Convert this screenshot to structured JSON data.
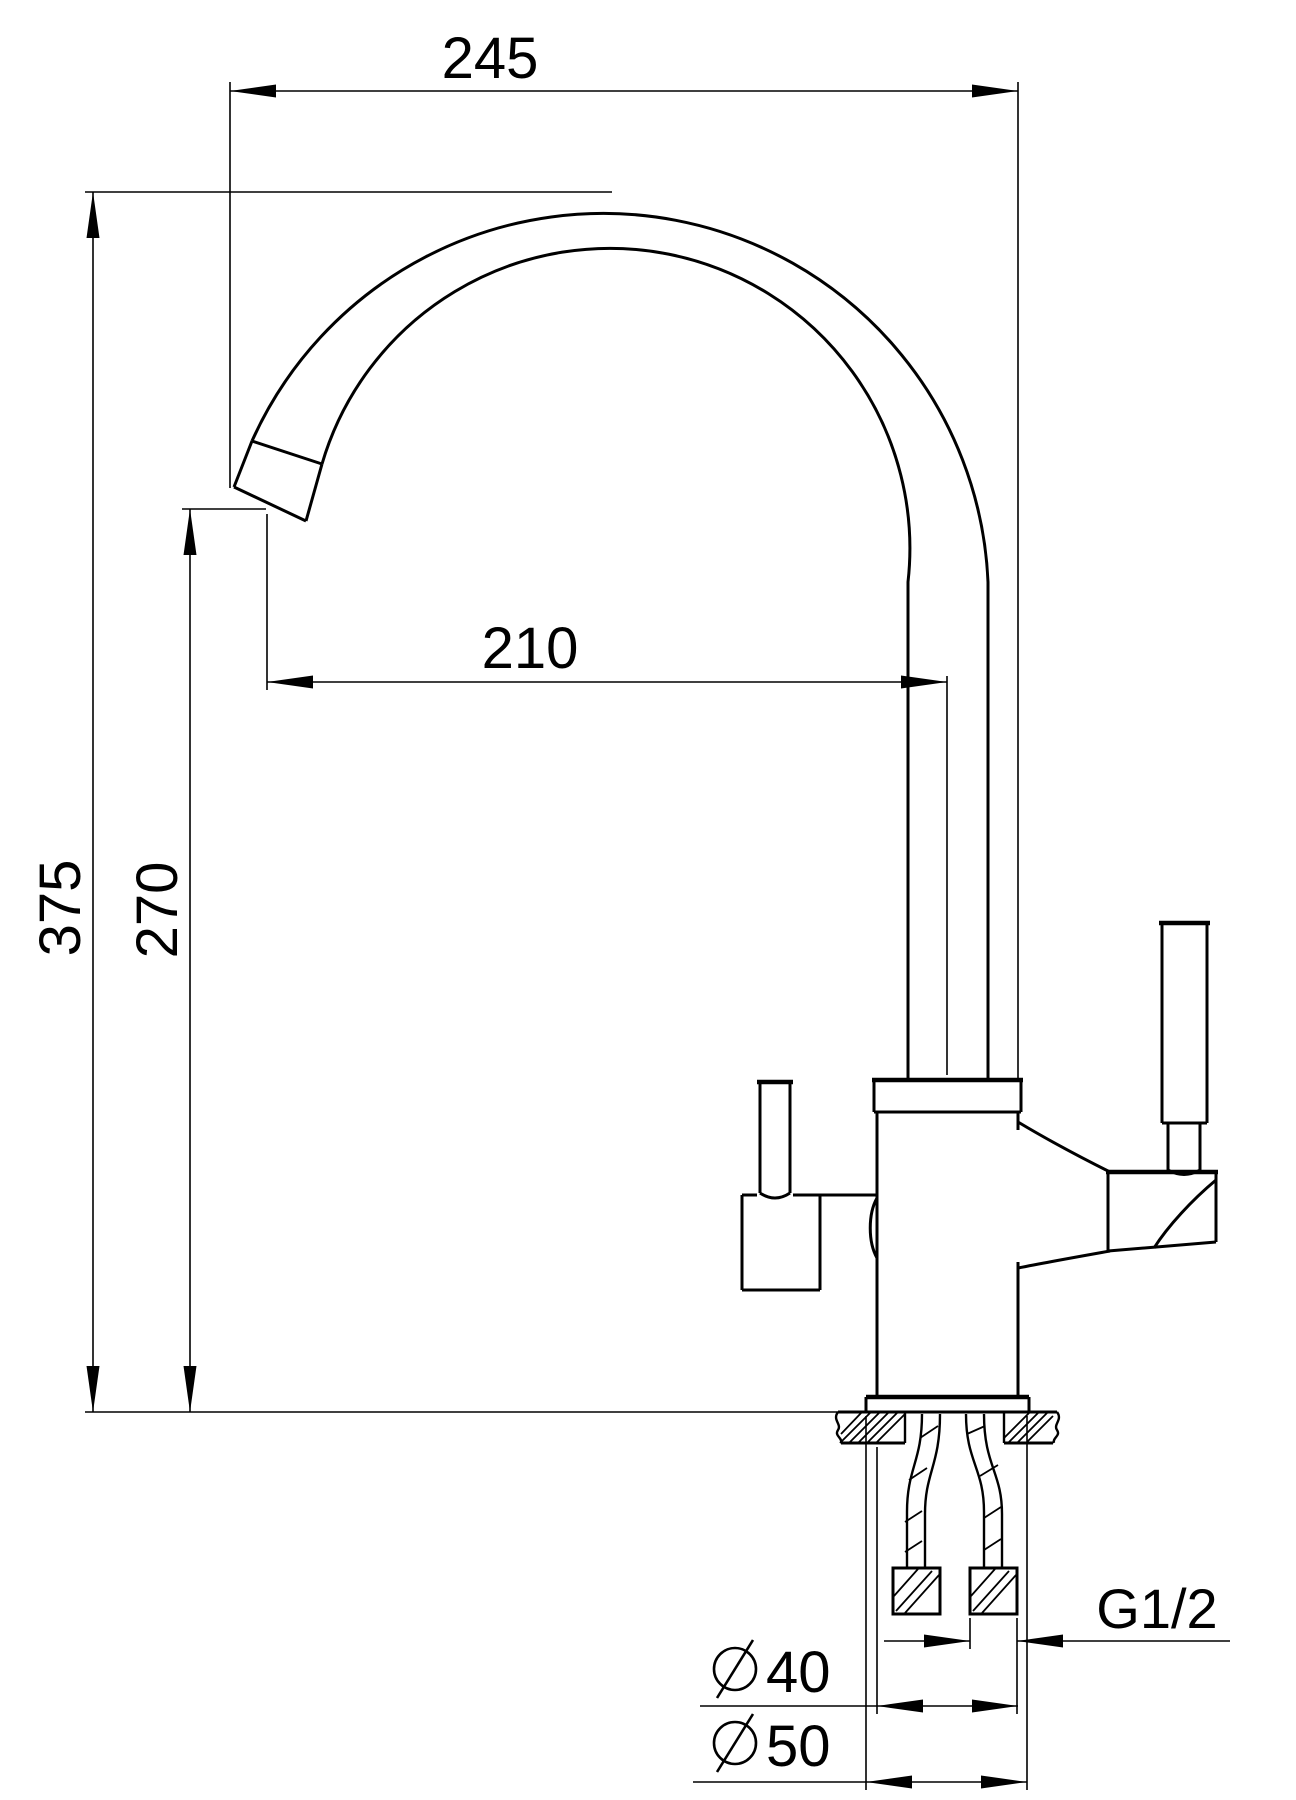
{
  "drawing": {
    "background": "#ffffff",
    "line_color": "#000000",
    "type": "faucet-installation-dimension-drawing",
    "dims": {
      "overall_reach": "245",
      "spout_reach": "210",
      "overall_height": "375",
      "spout_height": "270",
      "thread": "G1/2",
      "diameter_symbol": "⌀",
      "body_diameter_value": "40",
      "base_diameter_value": "50"
    }
  }
}
